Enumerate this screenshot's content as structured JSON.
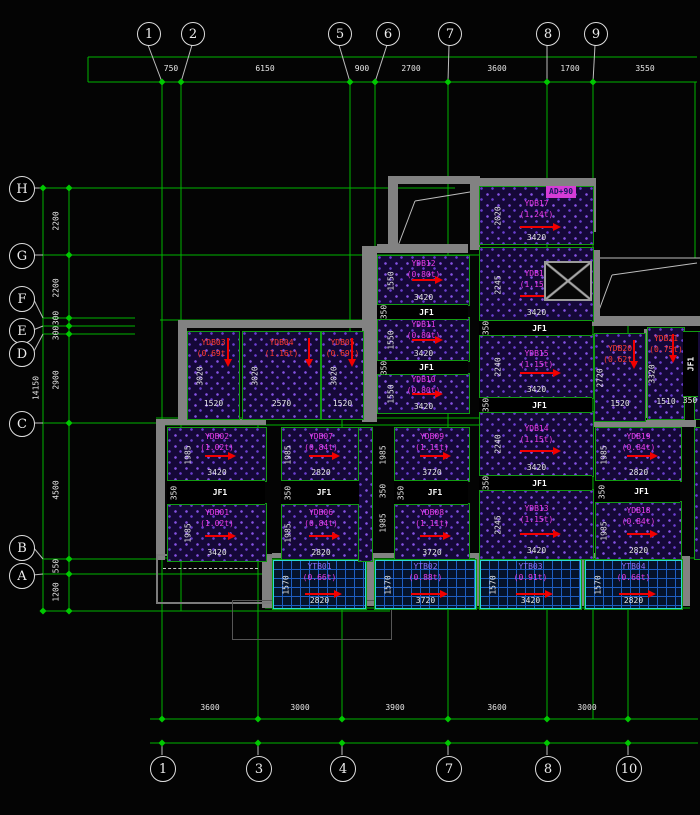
{
  "axes": {
    "top": {
      "bubbles": [
        "1",
        "2",
        "5",
        "6",
        "7",
        "8",
        "9"
      ],
      "dims": [
        "750",
        "6150",
        "900",
        "2700",
        "3600",
        "1700",
        "3550"
      ]
    },
    "bottom": {
      "bubbles": [
        "1",
        "3",
        "4",
        "7",
        "8",
        "10"
      ],
      "dims": [
        "3600",
        "3000",
        "3900",
        "3600",
        "3000"
      ]
    },
    "left": {
      "bubbles": [
        "H",
        "G",
        "F",
        "E",
        "D",
        "C",
        "B",
        "A"
      ],
      "dims": [
        "2200",
        "2200",
        "300",
        "300",
        "2900",
        "4500",
        "550",
        "1200"
      ],
      "total": "14150"
    }
  },
  "panels": [
    {
      "name": "YDB01",
      "load": "(1.02t)",
      "width_dim": "3420",
      "height_dim": "1985"
    },
    {
      "name": "YDB02",
      "load": "(1.02t)",
      "width_dim": "3420",
      "height_dim": "1985"
    },
    {
      "name": "YDB03",
      "load": "(0.69t)",
      "width_dim": "1520",
      "height_dim": "3020"
    },
    {
      "name": "YDB04",
      "load": "(1.16t)",
      "width_dim": "2570",
      "height_dim": "3020"
    },
    {
      "name": "YDB05",
      "load": "(0.69t)",
      "width_dim": "1520",
      "height_dim": "3020"
    },
    {
      "name": "YDB06",
      "load": "(0.84t)",
      "width_dim": "2820",
      "height_dim": "1985"
    },
    {
      "name": "YDB07",
      "load": "(0.84t)",
      "width_dim": "2820",
      "height_dim": "1985"
    },
    {
      "name": "YDB08",
      "load": "(1.11t)",
      "width_dim": "3720",
      "height_dim": "1985"
    },
    {
      "name": "YDB09",
      "load": "(1.11t)",
      "width_dim": "3720",
      "height_dim": "1985"
    },
    {
      "name": "YDB10",
      "load": "(0.80t)",
      "width_dim": "3420",
      "height_dim": "1550"
    },
    {
      "name": "YDB11",
      "load": "(0.80t)",
      "width_dim": "3420",
      "height_dim": "1550"
    },
    {
      "name": "YDB12",
      "load": "(0.80t)",
      "width_dim": "3420",
      "height_dim": "1550"
    },
    {
      "name": "YDB13",
      "load": "(1.15t)",
      "width_dim": "3420",
      "height_dim": "2245"
    },
    {
      "name": "YDB14",
      "load": "(1.15t)",
      "width_dim": "3420",
      "height_dim": "2240"
    },
    {
      "name": "YDB15",
      "load": "(1.15t)",
      "width_dim": "3420",
      "height_dim": "2240"
    },
    {
      "name": "YDB16",
      "load": "(1.15t)",
      "width_dim": "3420",
      "height_dim": "2245"
    },
    {
      "name": "YDB17",
      "load": "(1.24t)",
      "width_dim": "3420",
      "height_dim": "2020"
    },
    {
      "name": "YDB18",
      "load": "(0.84t)",
      "width_dim": "2820",
      "height_dim": "1985"
    },
    {
      "name": "YDB19",
      "load": "(0.84t)",
      "width_dim": "2820",
      "height_dim": "1985"
    },
    {
      "name": "YDB20",
      "load": "(0.62t)",
      "width_dim": "1520",
      "height_dim": "2720"
    },
    {
      "name": "YDB21",
      "load": "(0.75t)",
      "width_dim": "1510",
      "height_dim": "3320"
    },
    {
      "name": "YTB01",
      "load": "(0.66t)",
      "width_dim": "2820",
      "height_dim": "1570"
    },
    {
      "name": "YTB02",
      "load": "(0.88t)",
      "width_dim": "3720",
      "height_dim": "1570"
    },
    {
      "name": "YTB03",
      "load": "(0.91t)",
      "width_dim": "3420",
      "height_dim": "1570"
    },
    {
      "name": "YTB04",
      "load": "(0.66t)",
      "width_dim": "2820",
      "height_dim": "1570"
    }
  ],
  "strip": {
    "label": "JF1",
    "offset_dim": "350"
  },
  "extra_dims": {
    "between_bays": [
      "1985",
      "350",
      "1985"
    ],
    "right_edge_offset": "350"
  },
  "annotation_tag": "AD+90",
  "colors": {
    "grid_line": "#00b400",
    "dim_text": "#e6e6e6",
    "slab_label": "#ea3bea",
    "alt_label": "#ff3b30",
    "arrow": "#f20000",
    "hatch_dot": "#8453e2",
    "tag_bg": "#d63cd6"
  }
}
